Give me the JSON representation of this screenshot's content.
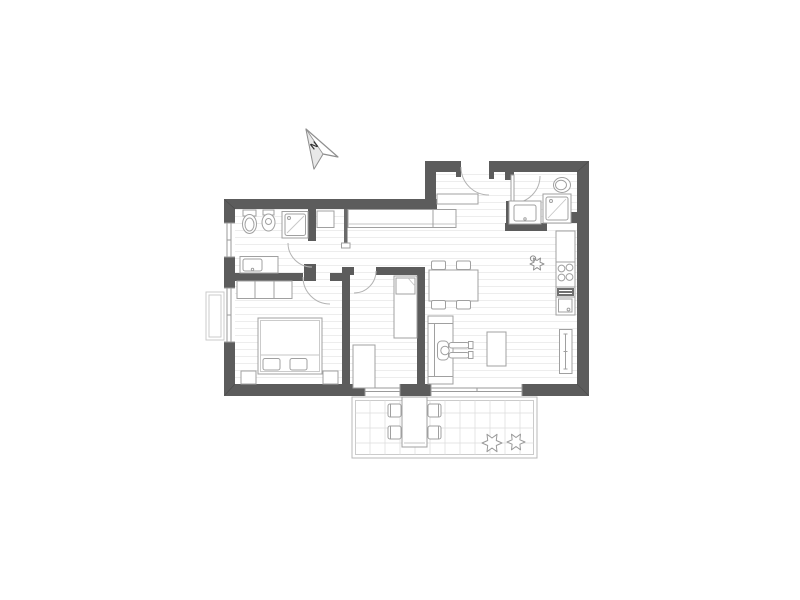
{
  "compass": {
    "label": "N"
  },
  "colors": {
    "wall": "#5c5c5c",
    "outline": "#a0a0a0",
    "outline_light": "#c6c6c6",
    "terrace_grid": "#dedede"
  },
  "plan": {
    "type": "apartment-floor-plan",
    "rooms": [
      "bathroom",
      "hallway",
      "bedroom",
      "small-room",
      "entry-hall",
      "second-bathroom",
      "kitchen",
      "living-dining-area",
      "terrace"
    ],
    "fixtures": [
      "north-arrow",
      "toilet",
      "bidet",
      "shower",
      "washbasin-counter",
      "hall-wardrobe",
      "small-closet",
      "shoe-cabinet",
      "double-bed",
      "pillows",
      "nightstands",
      "bedroom-wardrobe",
      "single-bed",
      "desk",
      "dining-table",
      "dining-chairs",
      "sofa",
      "person-sitting",
      "coffee-table",
      "kitchen-counter",
      "cooktop",
      "oven",
      "kitchen-sink",
      "tall-cabinet",
      "plant",
      "flower-box",
      "terrace-table",
      "terrace-chairs",
      "shrubs",
      "entrance-door",
      "interior-doors",
      "windows",
      "glass-sliding-door"
    ]
  }
}
